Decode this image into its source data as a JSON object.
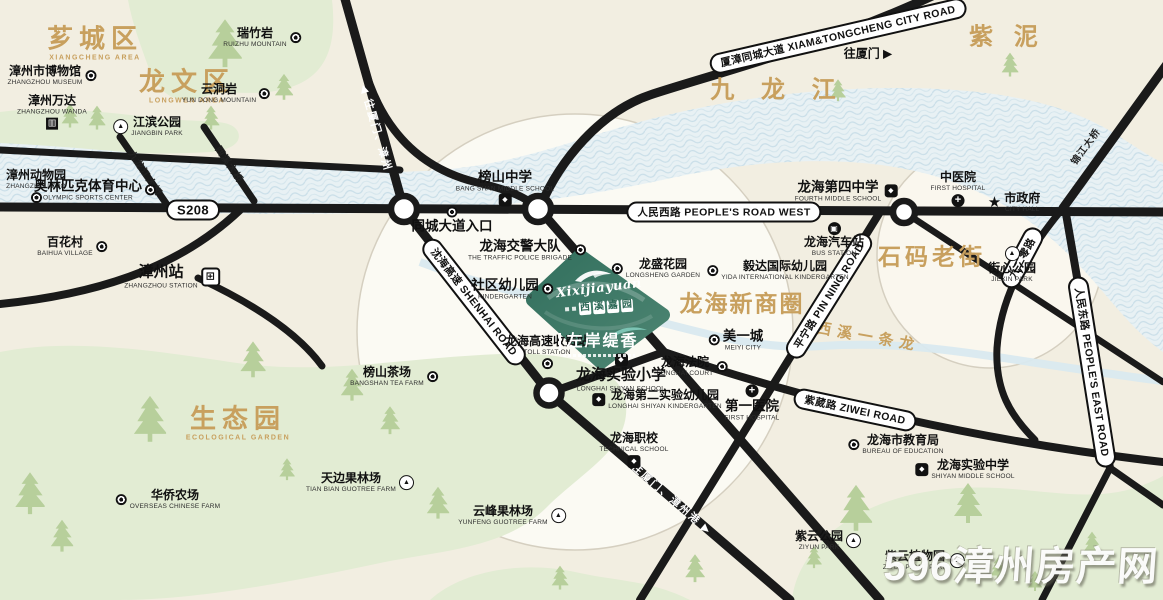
{
  "project": {
    "script": "Xixijiayuan",
    "name": "西溪嘉园",
    "tagline": "左岸缇香"
  },
  "watermark": {
    "text": "596漳州房产网"
  },
  "colors": {
    "accent_tan": "#c8a05e",
    "parcel_green": "#33705e",
    "river_blue": "#dcebf1",
    "road_black": "#1a1a1a",
    "blob_green": "#e2ecd3"
  },
  "areas": [
    {
      "id": "xiangcheng-district",
      "zh": "芗城区",
      "en": "XIANGCHENG AREA",
      "x": 95,
      "y": 44,
      "fs": 26,
      "ls": 6
    },
    {
      "id": "longwen-district",
      "zh": "龙文区",
      "en": "LONGWEN AREA",
      "x": 187,
      "y": 87,
      "fs": 26,
      "ls": 6
    },
    {
      "id": "ecological-garden",
      "zh": "生态园",
      "en": "ECOLOGICAL GARDEN",
      "x": 238,
      "y": 424,
      "fs": 26,
      "ls": 6
    },
    {
      "id": "jiulong-river",
      "zh": "九 龙 江",
      "x": 778,
      "y": 90,
      "fs": 24,
      "ls": 10
    },
    {
      "id": "zini",
      "zh": "紫 泥",
      "x": 1007,
      "y": 37,
      "fs": 24,
      "ls": 7
    },
    {
      "id": "shima-old-street",
      "zh": "石码老街",
      "x": 932,
      "y": 257,
      "fs": 23,
      "ls": 4
    },
    {
      "id": "longhai-new-business-circle",
      "zh": "龙海新商圈",
      "x": 742,
      "y": 304,
      "fs": 23,
      "ls": 2
    },
    {
      "id": "xixi-stream",
      "zh": "西溪一条龙",
      "x": 868,
      "y": 338,
      "fs": 15,
      "ls": 6,
      "rot": 10
    }
  ],
  "roads": {
    "labels": [
      {
        "id": "s208",
        "kind": "pill",
        "zh": "S208",
        "x": 193,
        "y": 210,
        "rot": 0,
        "fs": 13
      },
      {
        "id": "renmin-west-road",
        "kind": "pill",
        "zh": "人民西路 PEOPLE'S ROAD WEST",
        "x": 724,
        "y": 212,
        "rot": 0
      },
      {
        "id": "xiamzhang-tongcheng-avenue",
        "kind": "pill",
        "zh": "厦漳同城大道 XIAM&TONGCHENG CITY ROAD",
        "x": 838,
        "y": 36,
        "rot": -13
      },
      {
        "id": "shenhai-expressway",
        "kind": "pill",
        "zh": "沈海高速 SHENHAI ROAD",
        "x": 474,
        "y": 302,
        "rot": 52
      },
      {
        "id": "pinning-road",
        "kind": "pill",
        "zh": "平宁路 PIN NING ROAD",
        "x": 829,
        "y": 296,
        "rot": -58
      },
      {
        "id": "ziwei-road",
        "kind": "pill",
        "zh": "紫葳路 ZIWEI ROAD",
        "x": 855,
        "y": 410,
        "rot": 12
      },
      {
        "id": "renmin-east-road",
        "kind": "pill",
        "zh": "人民东路 PEOPLE'S EAST ROAD",
        "x": 1092,
        "y": 372,
        "rot": 81
      },
      {
        "id": "jiuerling-road",
        "kind": "pill",
        "zh": "九二零路",
        "x": 1022,
        "y": 258,
        "rot": -62
      },
      {
        "id": "to-xiamen-zhangzhou",
        "kind": "roadtext",
        "zh": "◀ 往厦门、漳州",
        "x": 376,
        "y": 128,
        "rot": 74
      },
      {
        "id": "to-xiamen-zhangzhou-port",
        "kind": "roadtext",
        "zh": "往厦门、漳州港 ▶",
        "x": 672,
        "y": 499,
        "rot": 41
      },
      {
        "id": "to-xiamen",
        "kind": "plain",
        "zh": "往厦门 ▶",
        "x": 868,
        "y": 53,
        "rot": 0
      },
      {
        "id": "jiulongjiang-bridge",
        "kind": "bridge",
        "zh": "九龙江大桥",
        "x": 146,
        "y": 173,
        "rot": 56
      },
      {
        "id": "xixi-bridge",
        "kind": "bridge",
        "zh": "西溪大桥",
        "x": 230,
        "y": 164,
        "rot": 56
      },
      {
        "id": "jinjiang-bridge",
        "kind": "bridge",
        "zh": "锦江大桥",
        "x": 1085,
        "y": 146,
        "rot": -54
      }
    ]
  },
  "pois": [
    {
      "id": "ruizhuyan",
      "zh": "瑞竹岩",
      "en": "RUIZHU MOUNTAIN",
      "x": 262,
      "y": 38,
      "icon": "dot-icon",
      "pos": "r"
    },
    {
      "id": "zhangzhou-museum",
      "zh": "漳州市博物馆",
      "en": "ZHANGZHOU MUSEUM",
      "x": 52,
      "y": 76,
      "icon": "dot-icon",
      "pos": "r"
    },
    {
      "id": "zhangzhou-wanda",
      "zh": "漳州万达",
      "en": "ZHANGZHOU WANDA",
      "x": 52,
      "y": 112,
      "icon": "building-icon",
      "pos": "b"
    },
    {
      "id": "jiangbin-park",
      "zh": "江滨公园",
      "en": "JIANGBIN PARK",
      "x": 148,
      "y": 127,
      "icon": "sail-icon",
      "pos": "l"
    },
    {
      "id": "yundong-mountain",
      "zh": "云洞岩",
      "en": "YUN DONG MOUNTAIN",
      "x": 226,
      "y": 94,
      "icon": "dot-icon",
      "pos": "r"
    },
    {
      "id": "zhangzhou-zoo",
      "zh": "漳州动物园",
      "en": "ZHANGZHOU ZOO",
      "x": 36,
      "y": 186,
      "icon": "dot-icon",
      "pos": "b"
    },
    {
      "id": "olympic-sports-center",
      "zh": "奥林匹克体育中心",
      "en": "OLYMPIC SPORTS CENTER",
      "x": 95,
      "y": 190,
      "icon": "dot-icon",
      "pos": "r",
      "s": 2
    },
    {
      "id": "baihua-village",
      "zh": "百花村",
      "en": "BAIHUA VILLAGE",
      "x": 72,
      "y": 247,
      "icon": "dot-icon",
      "pos": "r"
    },
    {
      "id": "zhangzhou-station",
      "zh": "漳州站",
      "en": "ZHANGZHOU STATION",
      "x": 172,
      "y": 277,
      "icon": "train-icon",
      "pos": "r",
      "s": 3
    },
    {
      "id": "bangshan-middle-school",
      "zh": "榜山中学",
      "en": "BANG SHAN MIDDLE SCHOOL",
      "x": 505,
      "y": 188,
      "icon": "school-icon",
      "pos": "b",
      "s": 2
    },
    {
      "id": "tongcheng-entrance",
      "zh": "同城大道入口",
      "x": 452,
      "y": 220,
      "icon": "dot-icon",
      "pos": "t",
      "s": 2
    },
    {
      "id": "traffic-police",
      "zh": "龙海交警大队",
      "en": "THE TRAFFIC POLICE BRIGADE",
      "x": 527,
      "y": 250,
      "icon": "dot-icon",
      "pos": "r",
      "s": 2
    },
    {
      "id": "community-kindergarten",
      "zh": "社区幼儿园",
      "en": "KINDERGARTEN",
      "x": 512,
      "y": 289,
      "icon": "dot-icon",
      "pos": "r",
      "s": 2
    },
    {
      "id": "longsheng-garden",
      "zh": "龙盛花园",
      "en": "LONGSHENG GARDEN",
      "x": 656,
      "y": 269,
      "icon": "dot-icon",
      "pos": "l"
    },
    {
      "id": "yida-kindergarten",
      "zh": "毅达国际幼儿园",
      "en": "YIDA INTERNATIONAL KINDERGARTEN",
      "x": 778,
      "y": 271,
      "icon": "dot-icon",
      "pos": "l"
    },
    {
      "id": "meiyi-city",
      "zh": "美一城",
      "en": "MEIYI CITY",
      "x": 736,
      "y": 340,
      "icon": "dot-icon",
      "pos": "l",
      "s": 2
    },
    {
      "id": "longhai-court",
      "zh": "龙海法院",
      "en": "LONGHAI COURT",
      "x": 692,
      "y": 367,
      "icon": "dot-icon",
      "pos": "r"
    },
    {
      "id": "first-hospital",
      "zh": "第一医院",
      "en": "FIRST HOSPITAL",
      "x": 752,
      "y": 403,
      "icon": "hospital-icon",
      "pos": "t",
      "s": 2
    },
    {
      "id": "tcm-hospital",
      "zh": "中医院",
      "en": "FIRST HOSPITAL",
      "x": 958,
      "y": 189,
      "icon": "hospital-icon",
      "pos": "b"
    },
    {
      "id": "city-hall",
      "zh": "市政府",
      "en": "CITY HALL",
      "x": 1014,
      "y": 203,
      "icon": "star-icon",
      "pos": "l"
    },
    {
      "id": "j_park",
      "zh": "街心公园",
      "en": "JIEXIN PARK",
      "x": 1012,
      "y": 265,
      "icon": "park-icon",
      "pos": "t"
    },
    {
      "id": "longhai-bus-station",
      "zh": "龙海汽车站",
      "en": "BUS STATION",
      "x": 834,
      "y": 240,
      "icon": "bus-icon",
      "pos": "t"
    },
    {
      "id": "fourth-middle-school",
      "zh": "龙海第四中学",
      "en": "FOURTH MIDDLE SCHOOL",
      "x": 846,
      "y": 191,
      "icon": "school-icon",
      "pos": "r",
      "s": 2
    },
    {
      "id": "shiyan-primary-school",
      "zh": "龙海实验小学",
      "en": "LONGHAI SHIYAN SCHOOL",
      "x": 621,
      "y": 373,
      "icon": "school-icon",
      "pos": "t",
      "s": 3
    },
    {
      "id": "second-shiyan-kindergarten",
      "zh": "龙海第二实验幼儿园",
      "en": "LONGHAI SHIYAN KINDERGARTEN",
      "x": 657,
      "y": 400,
      "icon": "school-icon",
      "pos": "l"
    },
    {
      "id": "toll-station",
      "zh": "龙海高速收费站",
      "en": "TOLL STATION",
      "x": 547,
      "y": 352,
      "icon": "dot-icon",
      "pos": "b"
    },
    {
      "id": "longhai-technical-school",
      "zh": "龙海职校",
      "en": "TECHNICAL SCHOOL",
      "x": 634,
      "y": 450,
      "icon": "school-icon",
      "pos": "b"
    },
    {
      "id": "bangshan-tea-farm",
      "zh": "榜山茶场",
      "en": "BANGSHAN TEA FARM",
      "x": 394,
      "y": 377,
      "icon": "dot-icon",
      "pos": "r"
    },
    {
      "id": "tianbian-farm",
      "zh": "天边果林场",
      "en": "TIAN BIAN GUOTREE FARM",
      "x": 360,
      "y": 483,
      "icon": "sail-icon",
      "pos": "r"
    },
    {
      "id": "overseas-chinese-farm",
      "zh": "华侨农场",
      "en": "OVERSEAS CHINESE FARM",
      "x": 168,
      "y": 500,
      "icon": "dot-icon",
      "pos": "l"
    },
    {
      "id": "yunfeng-farm",
      "zh": "云峰果林场",
      "en": "YUNFENG GUOTREE FARM",
      "x": 512,
      "y": 516,
      "icon": "sail-icon",
      "pos": "r"
    },
    {
      "id": "ziyun-park",
      "zh": "紫云公园",
      "en": "ZIYUN PARK",
      "x": 828,
      "y": 541,
      "icon": "park-icon",
      "pos": "r"
    },
    {
      "id": "ziyun-plant-park",
      "zh": "紫云植物园",
      "en": "ZIYUN PLANT PARK",
      "x": 924,
      "y": 561,
      "icon": "park-icon",
      "pos": "r"
    },
    {
      "id": "education-bureau",
      "zh": "龙海市教育局",
      "en": "BUREAU OF EDUCATION",
      "x": 896,
      "y": 445,
      "icon": "dot-icon",
      "pos": "l"
    },
    {
      "id": "shiyan-middle-school",
      "zh": "龙海实验中学",
      "en": "SHIYAN MIDDLE SCHOOL",
      "x": 965,
      "y": 470,
      "icon": "school-icon",
      "pos": "l"
    }
  ],
  "trees": [
    [
      225,
      60,
      1.2
    ],
    [
      284,
      96,
      0.65
    ],
    [
      70,
      124,
      0.6
    ],
    [
      97,
      126,
      0.6
    ],
    [
      211,
      126,
      0.6
    ],
    [
      1010,
      73,
      0.6
    ],
    [
      838,
      98,
      0.55
    ],
    [
      150,
      435,
      1.15
    ],
    [
      253,
      372,
      0.9
    ],
    [
      352,
      396,
      0.8
    ],
    [
      390,
      430,
      0.7
    ],
    [
      287,
      477,
      0.55
    ],
    [
      30,
      508,
      1.05
    ],
    [
      62,
      547,
      0.8
    ],
    [
      438,
      514,
      0.8
    ],
    [
      560,
      586,
      0.6
    ],
    [
      695,
      578,
      0.7
    ],
    [
      856,
      524,
      1.15
    ],
    [
      968,
      517,
      1.0
    ],
    [
      998,
      576,
      0.55
    ],
    [
      814,
      565,
      0.55
    ],
    [
      1092,
      552,
      0.6
    ],
    [
      1035,
      588,
      0.5
    ]
  ]
}
